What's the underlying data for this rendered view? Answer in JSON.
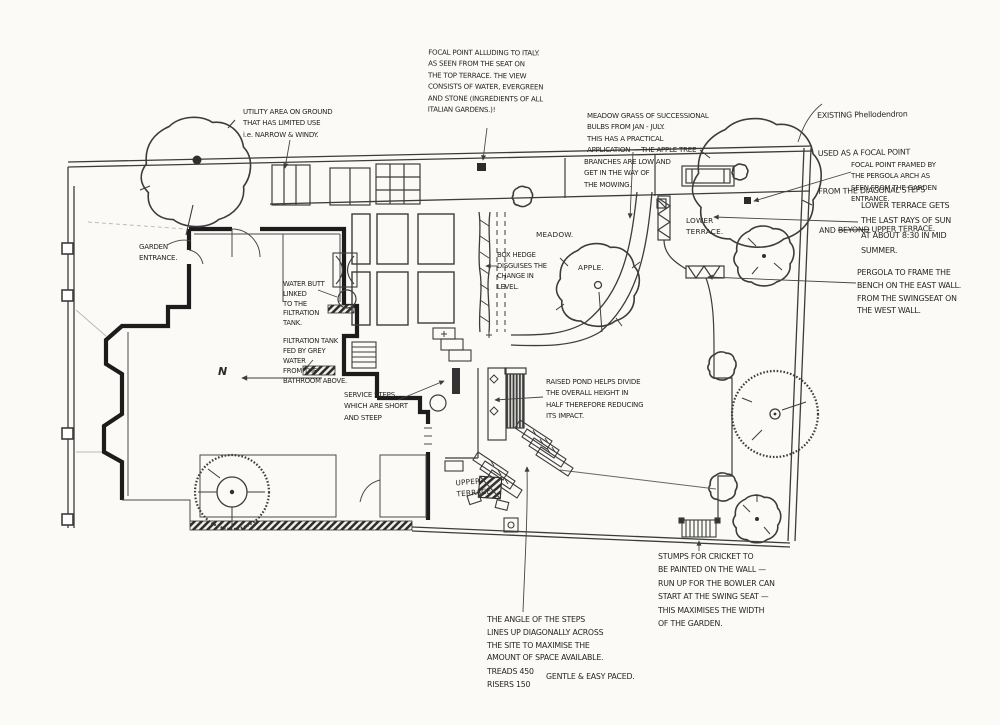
{
  "document": {
    "kind": "hand-drawn garden design concept plan",
    "ink_color": "#2f2f2f",
    "wall_color": "#1c1c1c",
    "paper_color": "#fbfaf7"
  },
  "labels": {
    "meadow": "MEADOW.",
    "apple": "APPLE.",
    "lower_terrace": "LOWER\nTERRACE.",
    "upper_terrace": "UPPER\nTERRACE",
    "north": "N"
  },
  "notes": {
    "focal_point_italy": {
      "text": "FOCAL POINT ALLUDING TO ITALY.\nAS SEEN FROM THE SEAT ON\nTHE TOP TERRACE. THE VIEW\nCONSISTS OF WATER, EVERGREEN\nAND STONE (INGREDIENTS OF ALL\nITALIAN GARDENS.)!"
    },
    "meadow_grass": {
      "text": "MEADOW GRASS OF SUCCESSIONAL\nBULBS FROM JAN - JULY.\nTHIS HAS A PRACTICAL\nAPPLICATION — THE APPLE TREE"
    },
    "branches": {
      "text": "BRANCHES ARE LOW AND\nGET IN THE WAY OF\nTHE MOWING."
    },
    "phellodendron": {
      "line1": "EXISTING Phellodendron",
      "line2": "USED AS A FOCAL POINT",
      "line3": "FROM THE DIAGONAL STEPS",
      "line4_pre": "AND ",
      "line4_struck": "BEYOND",
      "line4_post": " UPPER TERRACE."
    },
    "focal_framed": {
      "text": "FOCAL POINT FRAMED BY\nTHE PERGOLA ARCH AS\nSEEN FROM THE GARDEN\nENTRANCE."
    },
    "lower_sun": {
      "text": "LOWER TERRACE GETS\nTHE LAST RAYS OF SUN\nAT ABOUT 8:30 IN MID\nSUMMER."
    },
    "pergola_frame": {
      "text": "PERGOLA TO FRAME THE\nBENCH ON THE EAST WALL.\nFROM THE SWINGSEAT ON\nTHE WEST WALL."
    },
    "utility": {
      "text": "UTILITY AREA ON GROUND\nTHAT HAS LIMITED USE\ni.e. NARROW & WINDY."
    },
    "garden_entrance": {
      "text": "GARDEN\nENTRANCE."
    },
    "water_butt": {
      "text": "WATER BUTT\nLINKED\nTO THE\nFILTRATION\nTANK."
    },
    "filtration": {
      "text": "FILTRATION TANK\nFED BY GREY\nWATER\nFROM THE\nBATHROOM ABOVE."
    },
    "service_steps": {
      "text": "SERVICE STEPS\nWHICH ARE SHORT\nAND STEEP"
    },
    "raised_pond": {
      "text": "RAISED POND HELPS DIVIDE\nTHE OVERALL HEIGHT IN\nHALF THEREFORE REDUCING\nITS IMPACT."
    },
    "box_hedge": {
      "text": "BOX HEDGE\nDISGUISES THE\nCHANGE IN\nLEVEL."
    },
    "stumps": {
      "text": "STUMPS FOR CRICKET TO\nBE PAINTED ON THE WALL —\nRUN UP FOR THE BOWLER CAN\nSTART AT THE SWING SEAT —\nTHIS MAXIMISES THE WIDTH\nOF THE GARDEN."
    },
    "steps_angle": {
      "text": "THE ANGLE OF THE STEPS\nLINES UP DIAGONALLY ACROSS\nTHE SITE TO MAXIMISE THE\nAMOUNT OF SPACE AVAILABLE."
    },
    "treads": {
      "text": "TREADS 450\nRISERS 150"
    },
    "paced": {
      "text": "GENTLE & EASY PACED."
    }
  }
}
